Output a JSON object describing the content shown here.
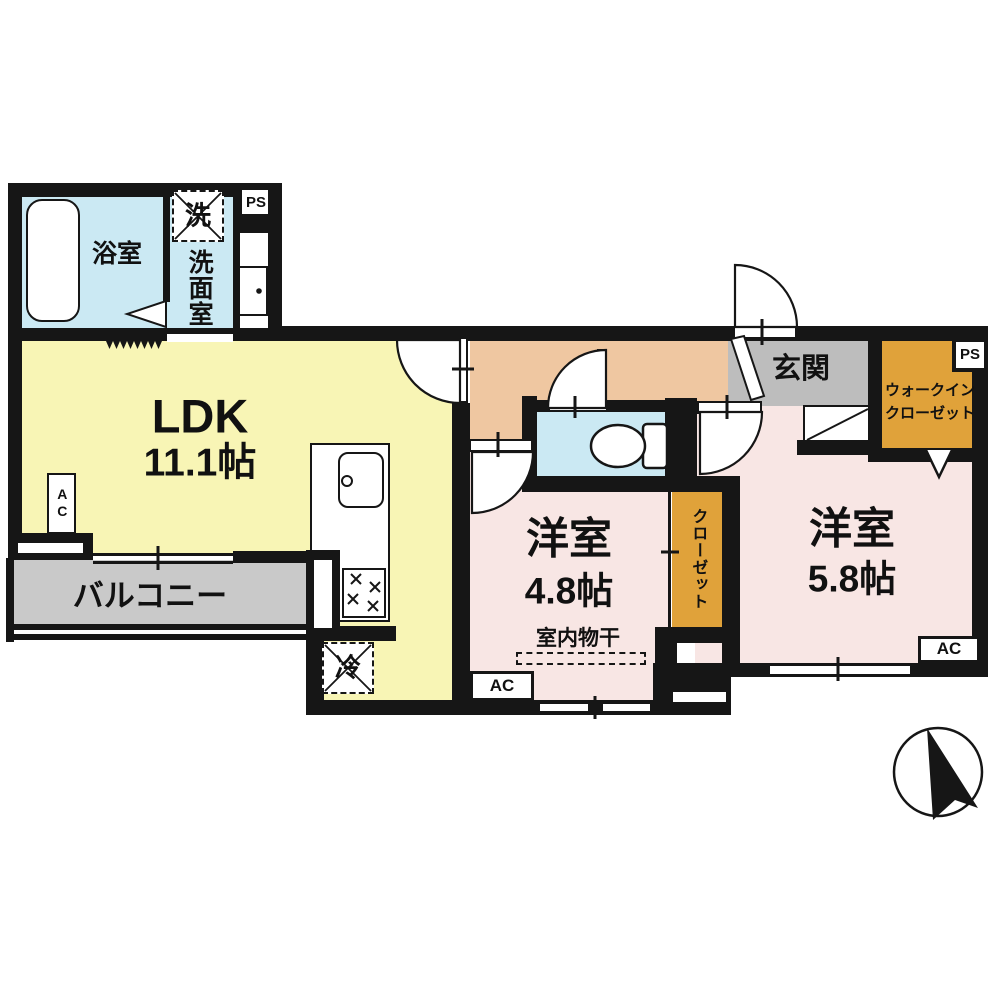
{
  "plan": {
    "bath": "浴室",
    "washroom": "洗面室",
    "washer_mark": "洗",
    "ps": "PS",
    "ldk_name": "LDK",
    "ldk_size": "11.1帖",
    "balcony": "バルコニー",
    "fridge_mark": "冷",
    "entrance": "玄関",
    "wic_line1": "ウォークイン",
    "wic_line2": "クローゼット",
    "room_right_name": "洋室",
    "room_right_size": "5.8帖",
    "room_center_name": "洋室",
    "room_center_size": "4.8帖",
    "indoor_drying": "室内物干",
    "closet": "クローゼット",
    "ac": "AC"
  },
  "colors": {
    "wall": "#161616",
    "ldk_floor": "#f8f5b5",
    "bath_floor": "#cbe9f3",
    "hall_floor": "#efc7a1",
    "bedroom_floor": "#f8e6e4",
    "entrance_floor": "#bdbdbd",
    "balcony_floor": "#c9c9c9",
    "closet_floor": "#e0a23a"
  }
}
